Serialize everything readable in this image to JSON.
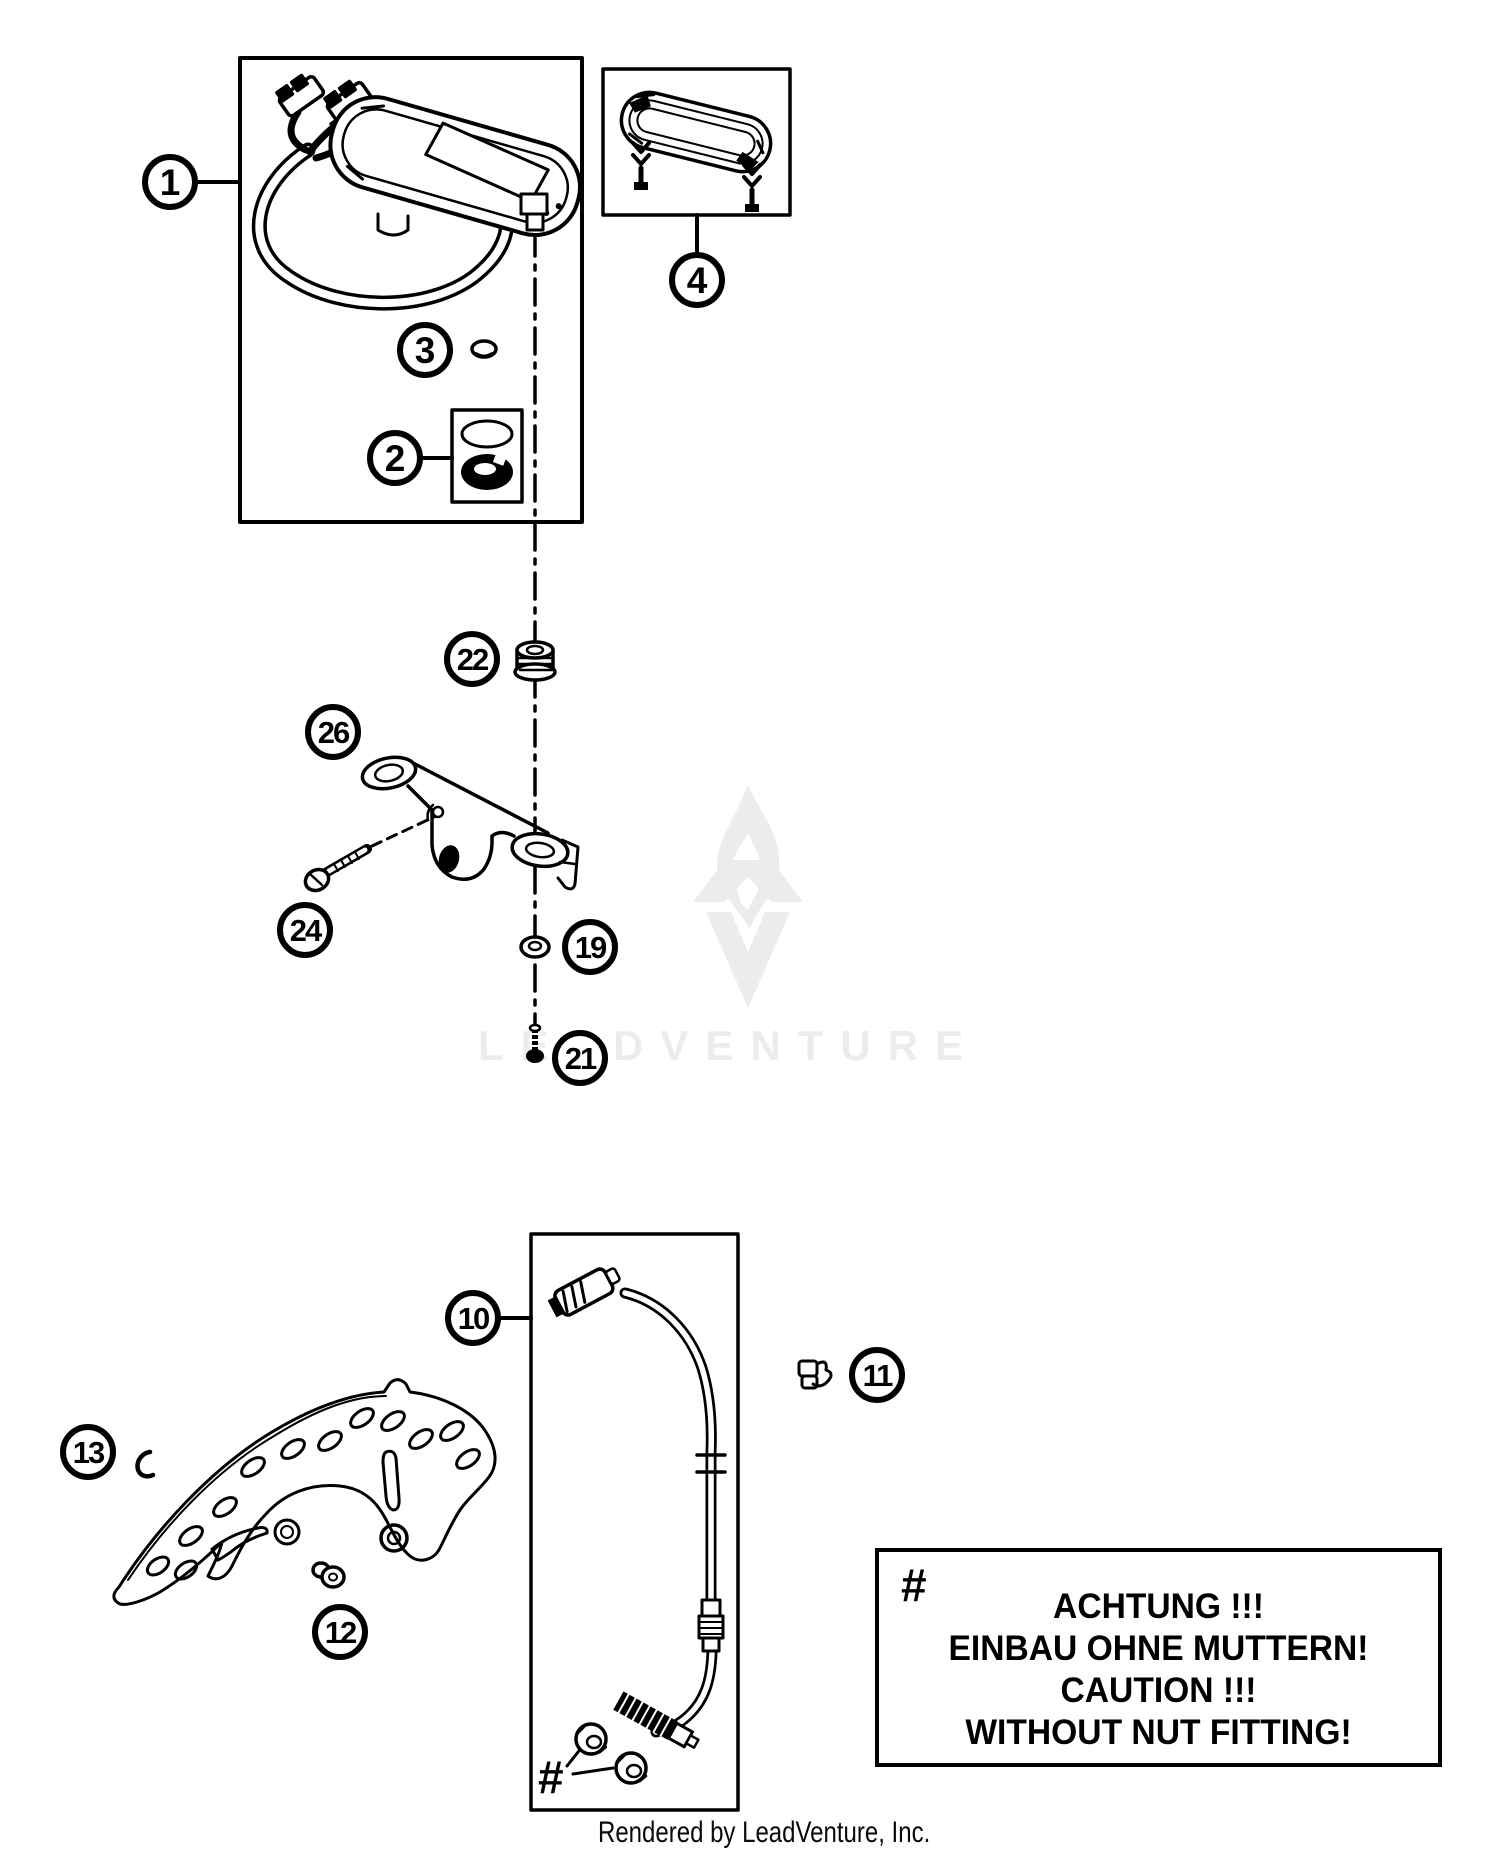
{
  "callouts": {
    "c1": "1",
    "c2": "2",
    "c3": "3",
    "c4": "4",
    "c10": "10",
    "c11": "11",
    "c12": "12",
    "c13": "13",
    "c19": "19",
    "c21": "21",
    "c22": "22",
    "c24": "24",
    "c26": "26"
  },
  "warning": {
    "symbol": "#",
    "lines": [
      "ACHTUNG !!!",
      "EINBAU OHNE MUTTERN!",
      "CAUTION !!!",
      "WITHOUT NUT FITTING!"
    ]
  },
  "nut_note": {
    "symbol": "#"
  },
  "watermark": {
    "text": "LEADVENTURE"
  },
  "footer": {
    "caption": "Rendered by LeadVenture, Inc."
  },
  "colors": {
    "ink": "#000000",
    "background": "#ffffff",
    "watermark_gray": "#ececec"
  }
}
